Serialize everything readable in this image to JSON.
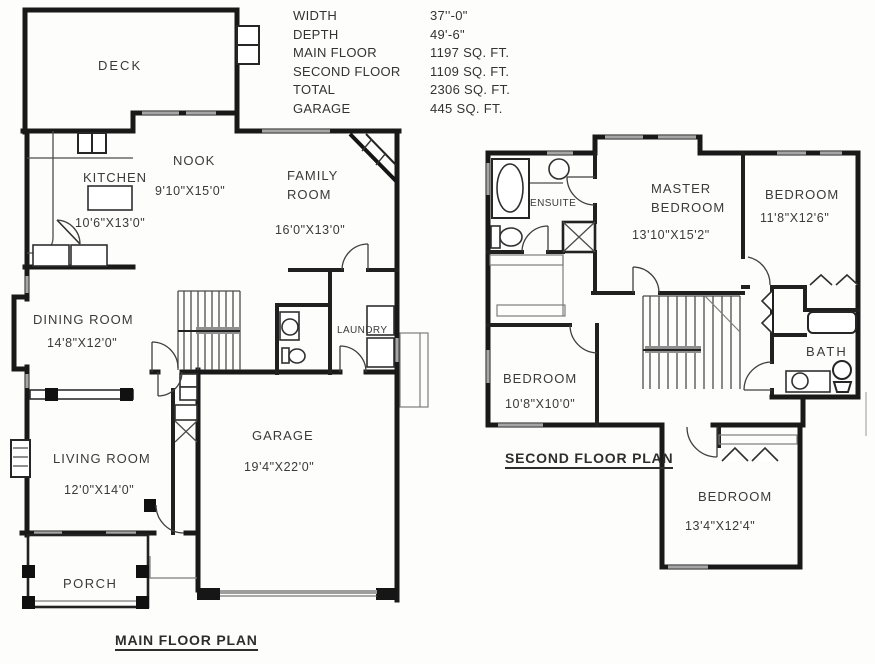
{
  "summary": {
    "rows": [
      {
        "label": "WIDTH",
        "value": "37''-0\""
      },
      {
        "label": "DEPTH",
        "value": "49'-6\""
      },
      {
        "label": "MAIN FLOOR",
        "value": "1197 SQ. FT."
      },
      {
        "label": "SECOND FLOOR",
        "value": "1109 SQ. FT."
      },
      {
        "label": "TOTAL",
        "value": "2306 SQ. FT."
      },
      {
        "label": "GARAGE",
        "value": "445 SQ. FT."
      }
    ]
  },
  "main_floor": {
    "title": "MAIN FLOOR PLAN",
    "labels": {
      "deck": {
        "name": "DECK"
      },
      "kitchen": {
        "name": "KITCHEN",
        "dims": "10'6\"X13'0\""
      },
      "nook": {
        "name": "NOOK",
        "dims": "9'10\"X15'0\""
      },
      "family_room": {
        "name": "FAMILY ROOM",
        "dims": "16'0\"X13'0\""
      },
      "dining_room": {
        "name": "DINING ROOM",
        "dims": "14'8\"X12'0\""
      },
      "living_room": {
        "name": "LIVING ROOM",
        "dims": "12'0\"X14'0\""
      },
      "garage": {
        "name": "GARAGE",
        "dims": "19'4\"X22'0\""
      },
      "laundry": {
        "name": "LAUNDRY"
      },
      "porch": {
        "name": "PORCH"
      }
    }
  },
  "second_floor": {
    "title": "SECOND FLOOR PLAN",
    "labels": {
      "master_bedroom": {
        "name": "MASTER BEDROOM",
        "dims": "13'10\"X15'2\""
      },
      "bedroom_top_right": {
        "name": "BEDROOM",
        "dims": "11'8\"X12'6\""
      },
      "bedroom_left": {
        "name": "BEDROOM",
        "dims": "10'8\"X10'0\""
      },
      "bedroom_bottom": {
        "name": "BEDROOM",
        "dims": "13'4\"X12'4\""
      },
      "bath": {
        "name": "BATH"
      },
      "ensuite": {
        "name": "ENSUITE"
      }
    }
  },
  "colors": {
    "wall": "#191919",
    "interior_wall": "#202020",
    "thin_line": "#4c4c4c",
    "window": "#a6a6a6",
    "text": "#3a3a3a",
    "background": "#fdfdfc"
  }
}
